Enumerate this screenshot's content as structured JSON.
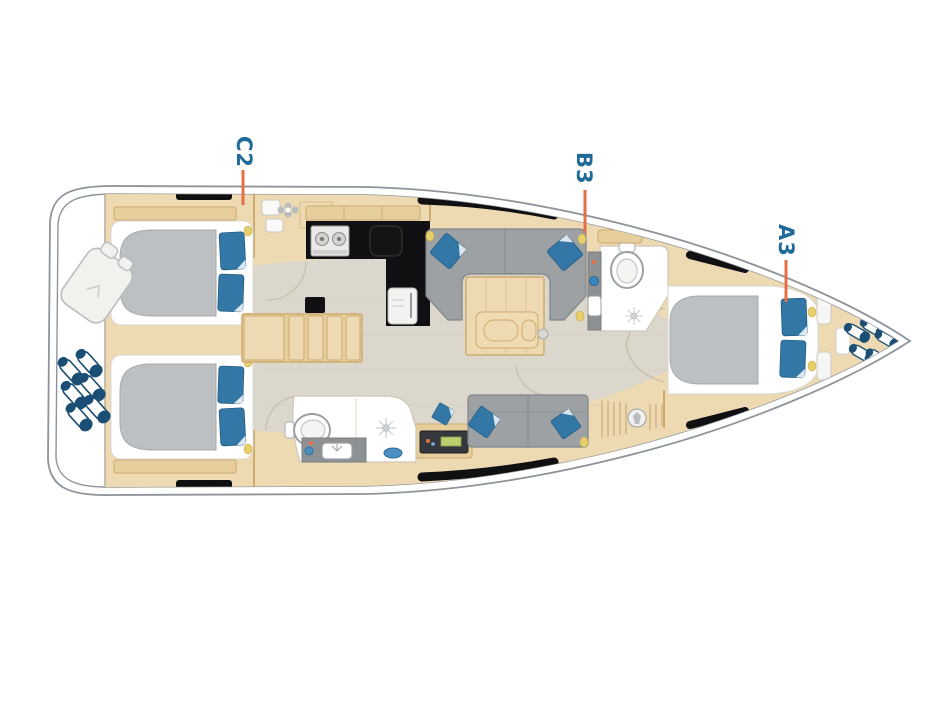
{
  "cabin_labels": [
    {
      "text": "C2"
    },
    {
      "text": "B3"
    },
    {
      "text": "A3"
    }
  ],
  "elements": [
    "hull",
    "life-raft",
    "stern-fender-cluster",
    "aft-cabin-starboard",
    "aft-cabin-port",
    "double-bed",
    "pillows",
    "companionway-stairs",
    "compression-post",
    "galley-counter",
    "stove",
    "sink",
    "fridge",
    "salon-settee",
    "salon-table",
    "nav-bench",
    "nav-instruments",
    "head-port",
    "head-forward",
    "toilet",
    "shower-drain",
    "washbasin",
    "forward-cabin",
    "bow-fender-cluster",
    "hull-window"
  ],
  "colors": {
    "page_bg": "#ffffff",
    "hull": "#8d949c",
    "wood": "#edd9b2",
    "wood_mid": "#e7cf9d",
    "wood_edge": "#cdab6e",
    "floor": "#dcd7cc",
    "floor_grain": "#cfc9bd",
    "uph": "#9da1a4",
    "uph_edge": "#80858a",
    "mattress": "#bdc0c2",
    "mattress_edge": "#a6aaac",
    "pillow": "#3377a6",
    "pillow_edge": "#235a82",
    "fender": "#1b4e74",
    "counter_black": "#101012",
    "accent": "#e56f47",
    "label": "#1f6b97",
    "lamp": "#e7d06b",
    "screen": "#bccf70",
    "steel": "#8d9194",
    "room_edge": "#cfc8b9",
    "arc": "#c6bca8"
  }
}
